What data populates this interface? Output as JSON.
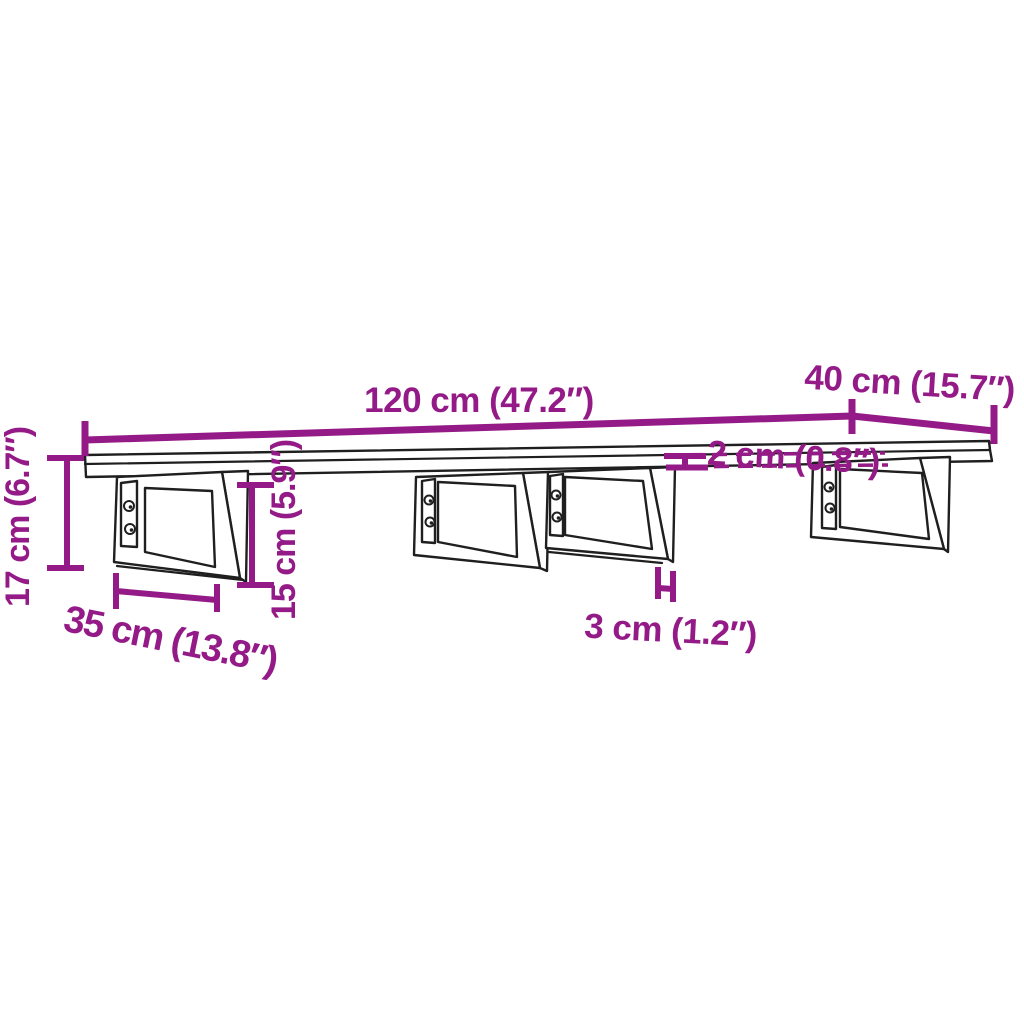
{
  "diagram": {
    "colors": {
      "dimension_color": "#941b87",
      "outline_color": "#1f1f1f",
      "background": "#ffffff"
    },
    "dimensions": {
      "shelf_width": "120 cm (47.2″)",
      "shelf_depth": "40 cm (15.7″)",
      "shelf_thickness": "2 cm (0.8″)",
      "total_height": "17 cm (6.7″)",
      "bracket_depth": "35 cm (13.8″)",
      "bracket_height": "15 cm (5.9″)",
      "front_bar_width": "3 cm (1.2″)"
    },
    "bracket_count": "4",
    "screws_per_bracket": "2"
  }
}
